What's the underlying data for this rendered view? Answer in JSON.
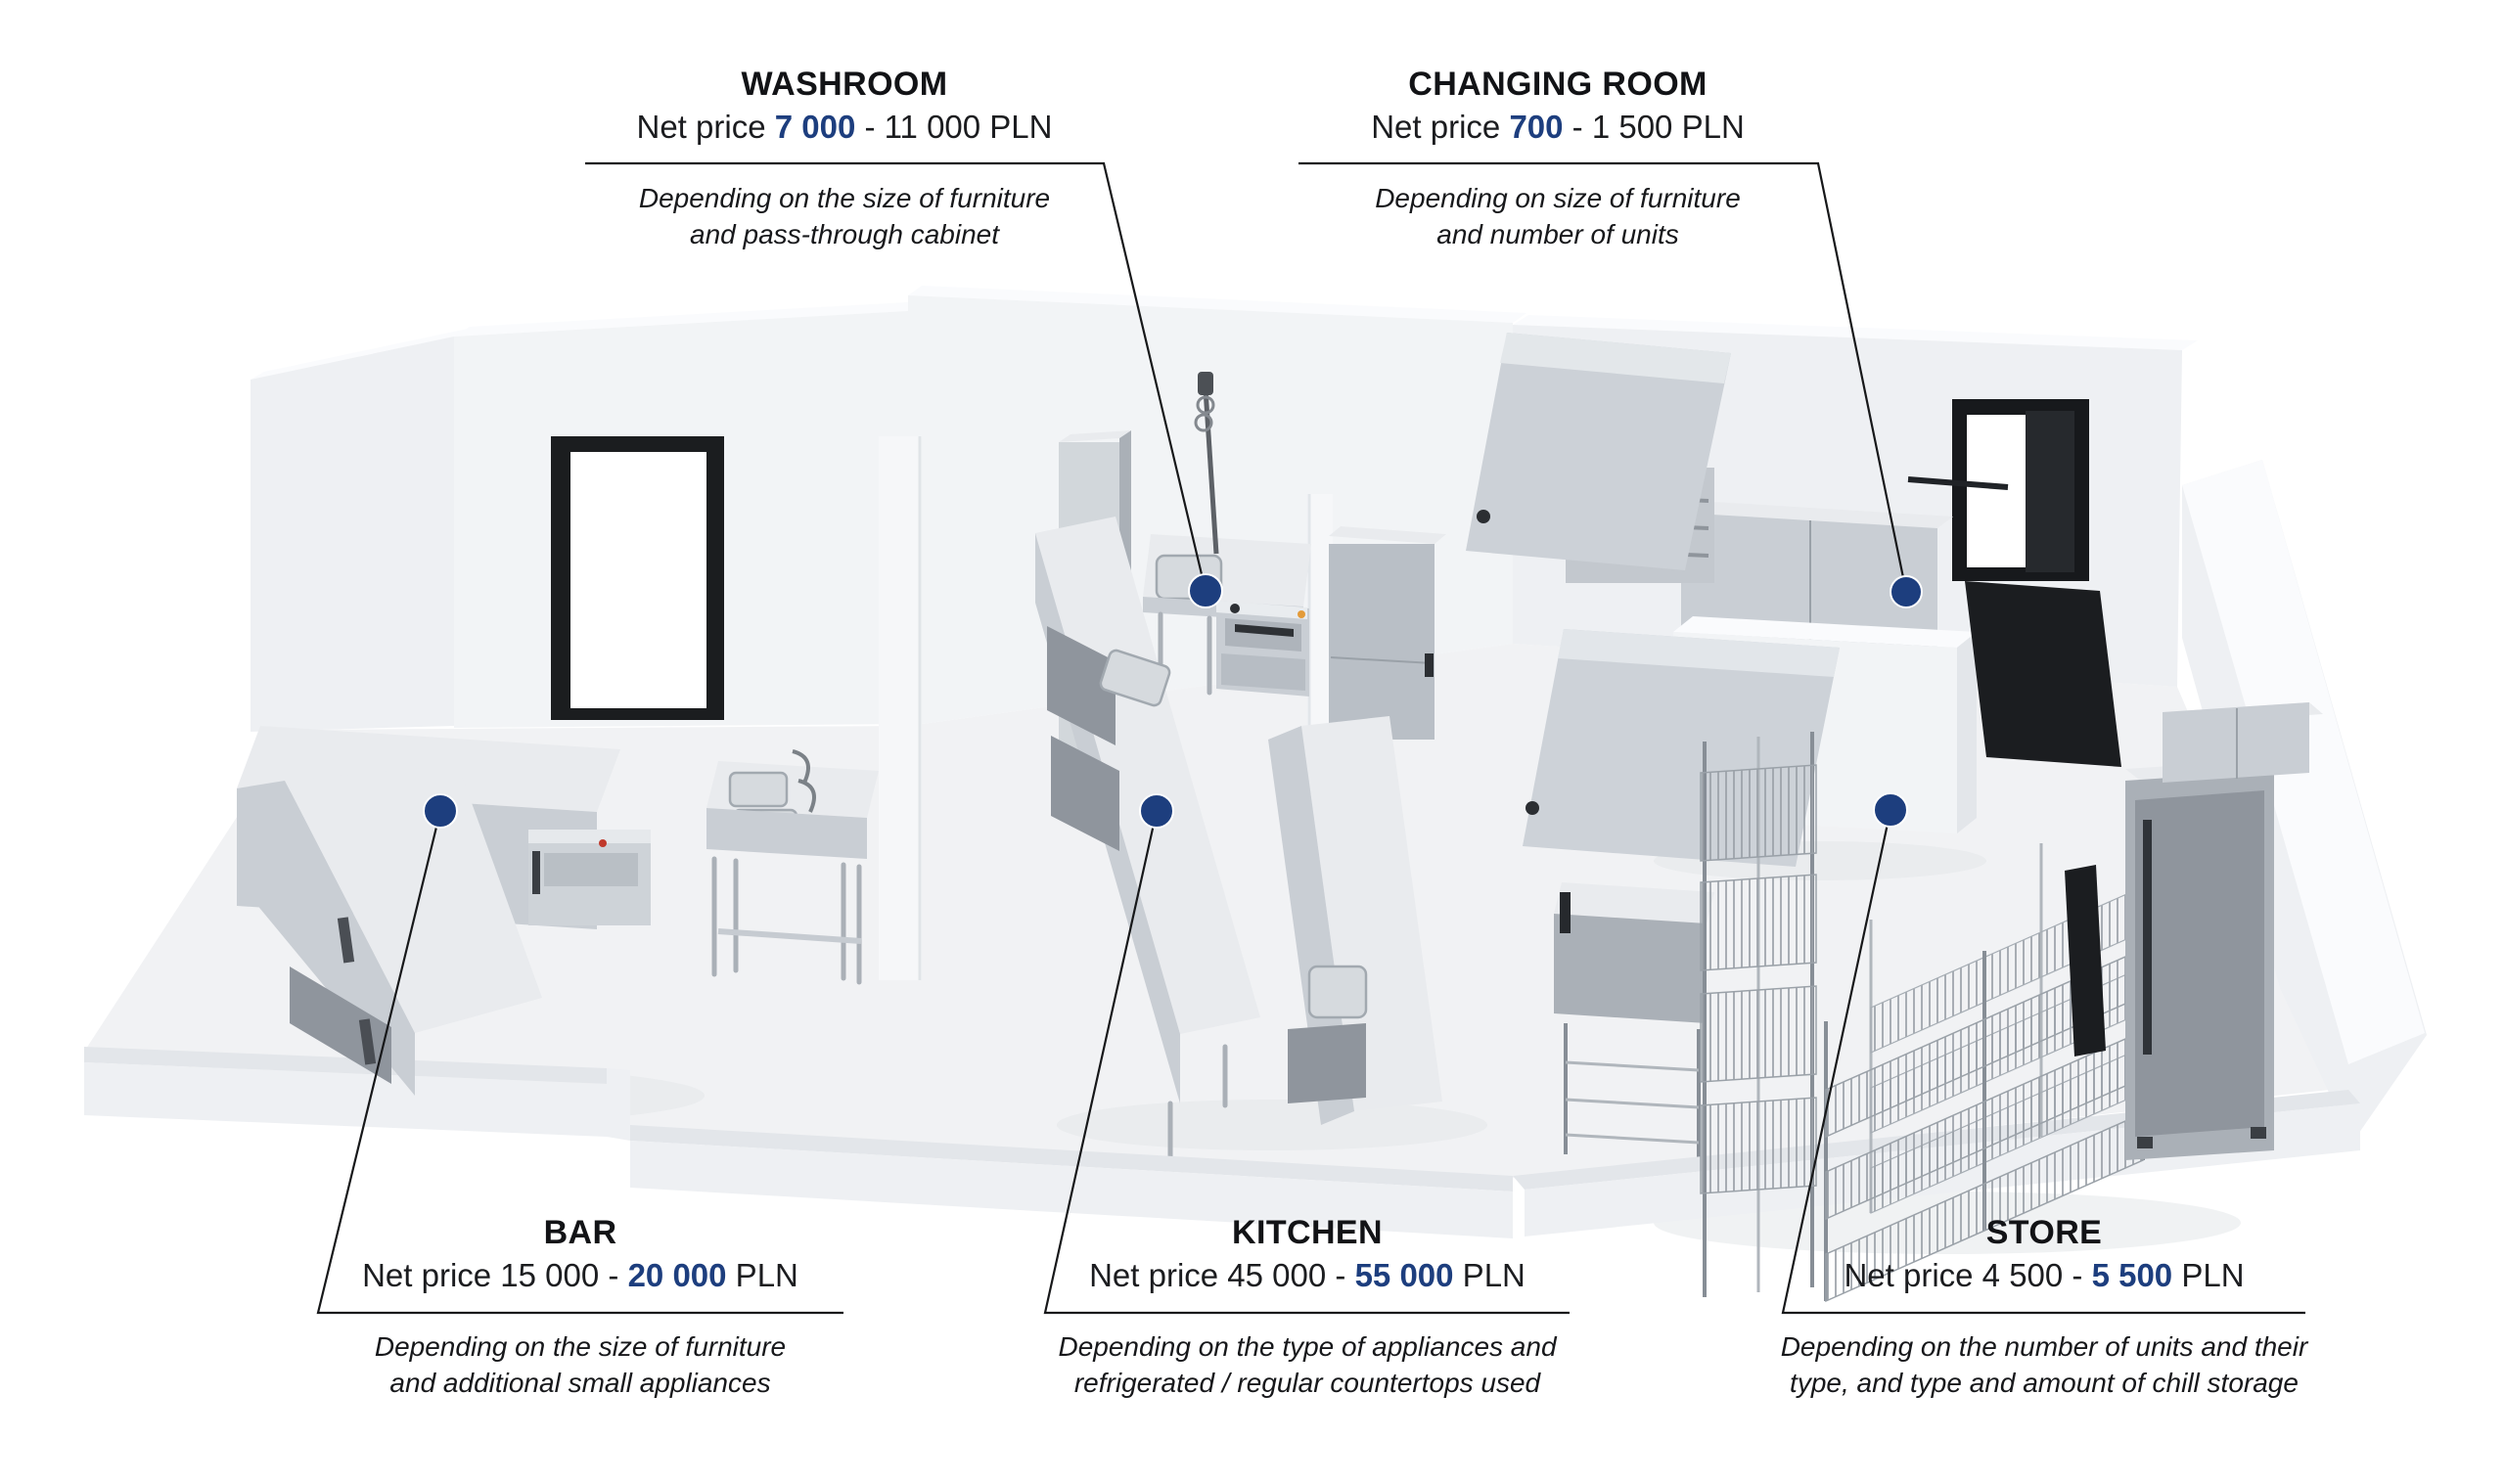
{
  "colors": {
    "accent_navy": "#1d3e7e",
    "leader_line": "#17181a",
    "title_text": "#121316",
    "price_text": "#1b1c1f",
    "note_text": "#17181b",
    "background": "#ffffff"
  },
  "labels": {
    "washroom": {
      "title": "WASHROOM",
      "price_segments": [
        {
          "text": "Net price ",
          "highlight": false
        },
        {
          "text": "7 000",
          "highlight": true
        },
        {
          "text": " - 11 000 PLN",
          "highlight": false
        }
      ],
      "note_lines": [
        "Depending on the size of furniture",
        "and pass-through cabinet"
      ]
    },
    "changing_room": {
      "title": "CHANGING ROOM",
      "price_segments": [
        {
          "text": "Net price ",
          "highlight": false
        },
        {
          "text": "700",
          "highlight": true
        },
        {
          "text": " - 1 500 PLN",
          "highlight": false
        }
      ],
      "note_lines": [
        "Depending on size of furniture",
        "and number of units"
      ]
    },
    "bar": {
      "title": "BAR",
      "price_segments": [
        {
          "text": "Net price 15 000 - ",
          "highlight": false
        },
        {
          "text": "20 000",
          "highlight": true
        },
        {
          "text": " PLN",
          "highlight": false
        }
      ],
      "note_lines": [
        "Depending on the size of furniture",
        "and additional small appliances"
      ]
    },
    "kitchen": {
      "title": "KITCHEN",
      "price_segments": [
        {
          "text": "Net price 45 000 - ",
          "highlight": false
        },
        {
          "text": "55 000",
          "highlight": true
        },
        {
          "text": " PLN",
          "highlight": false
        }
      ],
      "note_lines": [
        "Depending on the type of appliances and",
        "refrigerated / regular countertops used"
      ]
    },
    "store": {
      "title": "STORE",
      "price_segments": [
        {
          "text": "Net price 4 500 - ",
          "highlight": false
        },
        {
          "text": "5 500",
          "highlight": true
        },
        {
          "text": " PLN",
          "highlight": false
        }
      ],
      "note_lines": [
        "Depending on the number of units and their",
        "type, and type and amount of chill storage"
      ]
    }
  }
}
